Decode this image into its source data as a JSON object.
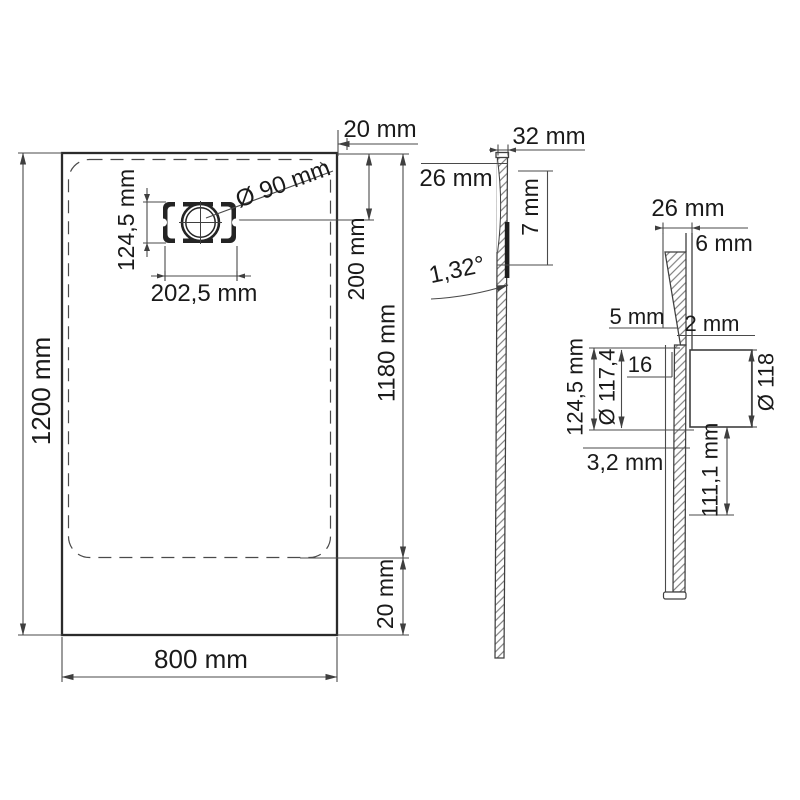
{
  "drawing": {
    "type": "shower-tray dimensional drawing",
    "colors": {
      "background": "#ffffff",
      "line": "#3f3f3f",
      "text": "#1a1a1a"
    },
    "plan": {
      "length": "1200 mm",
      "width": "800 mm",
      "edge_top": "20 mm",
      "edge_bottom": "20 mm",
      "inner_length": "1180 mm",
      "drain_center": "200 mm",
      "drain_plate_width": "202,5 mm",
      "drain_plate_height": "124,5 mm",
      "drain_hole": "Ø 90 mm"
    },
    "side": {
      "thickness": "32 mm",
      "rim": "26 mm",
      "recess": "7 mm",
      "angle": "1,32°"
    },
    "section": {
      "rim": "26 mm",
      "wall": "6 mm",
      "floor": "5 mm",
      "gap": "2 mm",
      "recess_dia": "124,5 mm",
      "hole_dia": "Ø 117,4",
      "plate": "16",
      "flange_dia": "Ø 118",
      "bottom": "3,2 mm",
      "pipe": "111,1 mm"
    }
  }
}
